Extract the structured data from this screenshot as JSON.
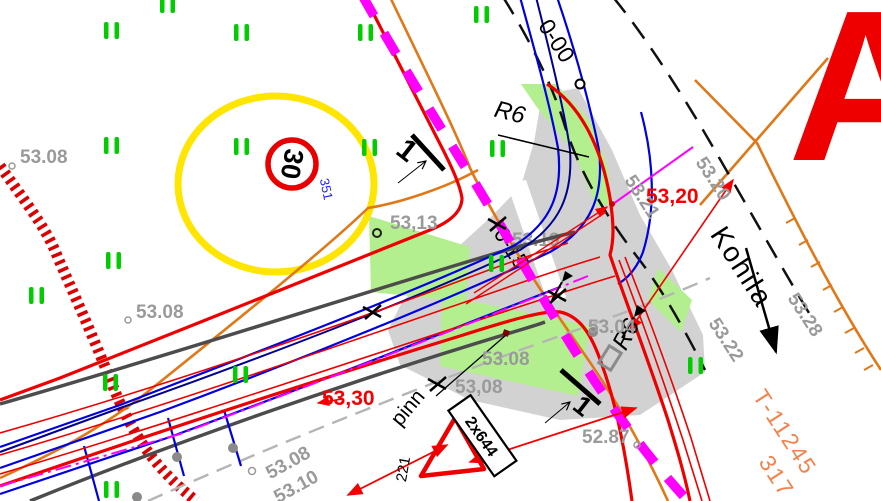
{
  "colors": {
    "design_red": "#f40000",
    "curb_red": "#ee0000",
    "hatch_red": "#dd0000",
    "fence_orange": "#e07818",
    "cadastral_orange": "#f4824a",
    "boundary_magenta": "#ff00ff",
    "design_blue": "#0000e0",
    "axis_navy": "#000090",
    "vegetation_green": "#00cc00",
    "grass_fill": "#b4ef8f",
    "pavement_gray": "#d2d2d2",
    "label_gray": "#9a9a9a",
    "existing_gray": "#4c4c4c",
    "centerline_gray": "#b5b5b5",
    "sign_yellow": "#ffe500"
  },
  "spot_heights": [
    {
      "text": "53.08"
    },
    {
      "text": "53.08"
    },
    {
      "text": "53,13"
    },
    {
      "text": "53.19"
    },
    {
      "text": "53.08"
    },
    {
      "text": "53,08"
    },
    {
      "text": "53.04"
    },
    {
      "text": "52.87"
    },
    {
      "text": "53.20"
    },
    {
      "text": "53.21"
    },
    {
      "text": "53.28"
    },
    {
      "text": "53.22"
    },
    {
      "text": "53.08"
    },
    {
      "text": "53.10"
    }
  ],
  "design_levels": {
    "junction": "53,20",
    "west": "53,30"
  },
  "stations": {
    "start": "0-00",
    "junction": "0-15"
  },
  "radii": {
    "north": "R6",
    "south": "R6"
  },
  "road_name": "Kohila",
  "survey_note": "pinn",
  "signs": {
    "speed_limit": "30",
    "speed_sign_id": "351",
    "yield_plate": "2x644",
    "yield_sign_id": "221"
  },
  "section_markers": {
    "first": "1",
    "second": "1"
  },
  "cadastral": {
    "line1": "T-11245",
    "line2": "317"
  },
  "corner_letter": "A"
}
